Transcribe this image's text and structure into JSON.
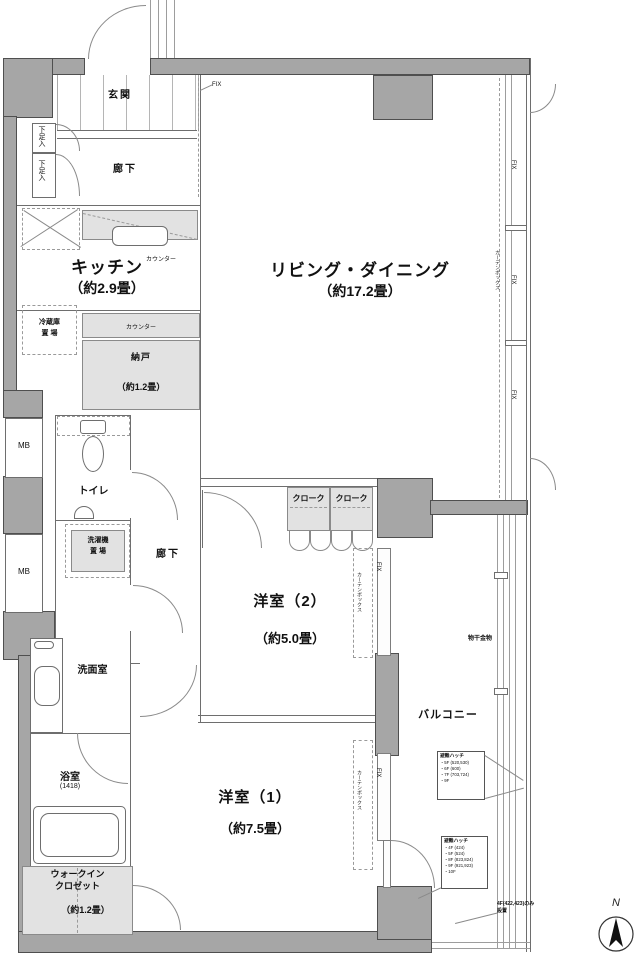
{
  "rooms": {
    "genkan": {
      "label": "玄関"
    },
    "hall_up": {
      "label": "廊下"
    },
    "hall_low": {
      "label": "廊下"
    },
    "kitchen": {
      "label": "キッチン",
      "size": "（約2.9畳）"
    },
    "living": {
      "label": "リビング・ダイニング",
      "size": "（約17.2畳）"
    },
    "nando": {
      "label": "納戸",
      "size": "（約1.2畳）"
    },
    "toilet": {
      "label": "トイレ"
    },
    "washroom": {
      "label": "洗面室"
    },
    "bath": {
      "label": "浴室",
      "size": "(1418)"
    },
    "bedroom2": {
      "label": "洋室（2）",
      "size": "（約5.0畳）"
    },
    "bedroom1": {
      "label": "洋室（1）",
      "size": "（約7.5畳）"
    },
    "wic": {
      "line1": "ウォークイン",
      "line2": "クロゼット",
      "size": "（約1.2畳）"
    },
    "balcony": {
      "label": "バルコニー"
    }
  },
  "fixtures": {
    "mb": "MB",
    "shoe": "下足入",
    "counter": "カウンター",
    "fridge1": "冷蔵庫",
    "fridge2": "置 場",
    "washer1": "洗濯機",
    "washer2": "置 場",
    "cloak": "クローク",
    "fix": "FIX",
    "curtain_box": "カーテンボックス",
    "laundry_hook": "物干金物"
  },
  "notes": {
    "hatch1": {
      "title": "避難ハッチ",
      "lines": [
        "・5F (520,530)",
        "・6F (600)",
        "・7F (703,724)",
        "・9F"
      ]
    },
    "hatch2": {
      "title": "避難ハッチ",
      "lines": [
        "・4F (424)",
        "・5F (524)",
        "・8F (823,824)",
        "・9F (921,923)",
        "・10F"
      ]
    },
    "corner1": "4F(422,423)のみ",
    "corner2": "設置",
    "compass_n": "N"
  }
}
